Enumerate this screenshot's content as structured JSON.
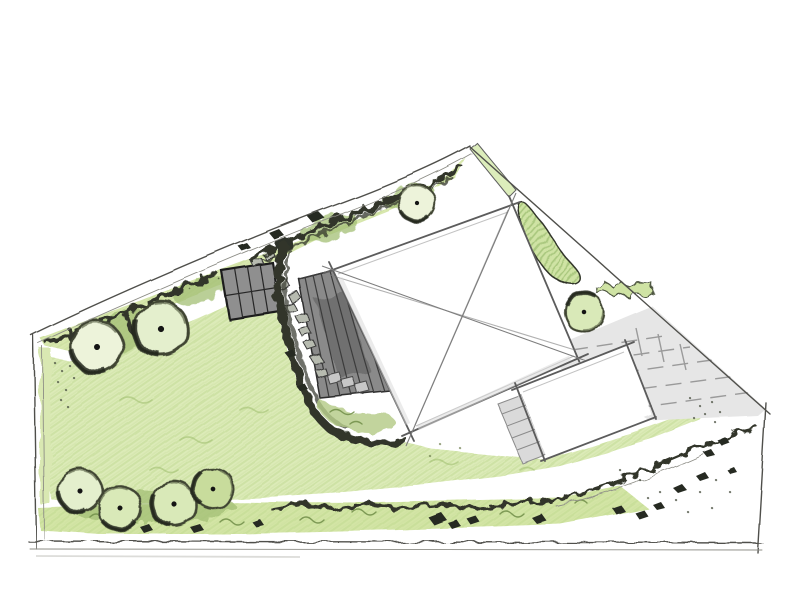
{
  "document": {
    "kind": "hand-drawn landscape garden design site plan, colored-pencil sketch, no text labels"
  },
  "palette": {
    "paper": "#ffffff",
    "lawn": "#dcebb8",
    "strip": "#d3e5a5",
    "band": "#d9e8af",
    "bed": "#cfe3a4",
    "hedge": "#9cbb6d",
    "planting_dark": "#31362a",
    "tree_pale": "#edf3da",
    "tree_light": "#e4efcd",
    "tree_green": "#d9e9b8",
    "tree_deep": "#c8dc9c",
    "deck": "#8a8a8a",
    "shed": "#8f8f8f",
    "paving": "#e6e6e6",
    "stone": "#b7bbb0",
    "rock": "#262a21",
    "house": "#ffffff",
    "outline": "#5c5c5c",
    "boundary": "#50504b"
  },
  "features": {
    "site_boundary": "irregular five-sided plot, apex at top, wide base at bottom",
    "structures": [
      {
        "name": "main-house",
        "style": "white square roof plan with X ridge lines"
      },
      {
        "name": "outbuilding-garage",
        "style": "white rectangle, lower right of house"
      },
      {
        "name": "timber-deck",
        "style": "dark hatched deck on west side of house"
      },
      {
        "name": "paved-shed-base",
        "style": "small dark gridded square, upper left"
      }
    ],
    "surfaces": [
      "lawn",
      "gravel-paving-driveway",
      "stepping-stones",
      "steps"
    ],
    "planting": {
      "round_trees": 8,
      "borders": "mixed planting along top-left boundary, central curved border, bottom strip",
      "boulders": "scattered dark rocks"
    }
  }
}
